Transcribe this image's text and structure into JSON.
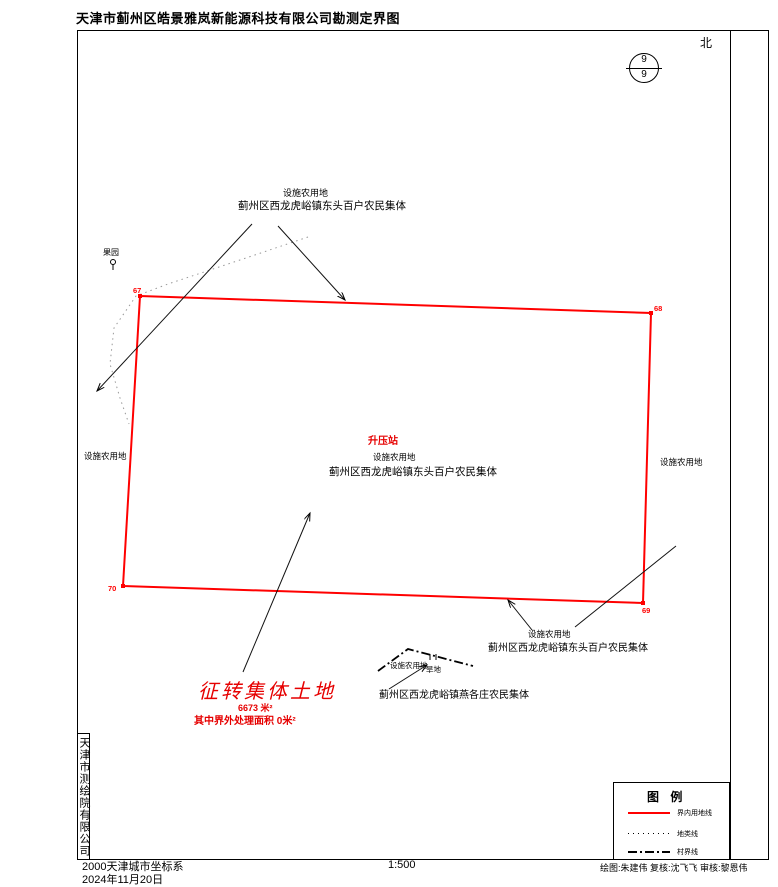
{
  "page": {
    "title": "天津市蓟州区皓景雅岚新能源科技有限公司勘测定界图"
  },
  "compass": {
    "north_label": "北",
    "sheet_number_top": "9",
    "sheet_number_bottom": "9"
  },
  "map": {
    "corners": [
      {
        "id": "67"
      },
      {
        "id": "68"
      },
      {
        "id": "69"
      },
      {
        "id": "70"
      }
    ],
    "labels": {
      "top_parcel_type": "设施农用地",
      "top_parcel_owner": "蓟州区西龙虎峪镇东头百户农民集体",
      "orchard": "果园",
      "station": "升压站",
      "center_parcel_type": "设施农用地",
      "center_parcel_owner": "蓟州区西龙虎峪镇东头百户农民集体",
      "left_parcel_type": "设施农用地",
      "right_parcel_type": "设施农用地",
      "bottom_right_parcel_type": "设施农用地",
      "bottom_right_parcel_owner": "蓟州区西龙虎峪镇东头百户农民集体",
      "bottom_mid_parcel_type": "设施农用地",
      "bottom_mid_dry_land": "旱地",
      "bottom_mid_parcel_owner": "蓟州区西龙虎峪镇燕各庄农民集体"
    },
    "acquisition_note": {
      "title": "征转集体土地",
      "area": "6673  米²",
      "outside_area": "其中界外处理面积  0米²"
    }
  },
  "legend": {
    "title": "图 例",
    "items": [
      {
        "label": "界内用地线",
        "style": "solid-red"
      },
      {
        "label": "地类线",
        "style": "dotted"
      },
      {
        "label": "村界线",
        "style": "dash-dot"
      }
    ]
  },
  "footer": {
    "coordinate_system": "2000天津城市坐标系",
    "date": "2024年11月20日",
    "scale": "1:500",
    "credits": "绘图:朱建伟  复核:沈飞飞  审核:黎恩伟",
    "agency": "天津市测绘院有限公司"
  },
  "colors": {
    "boundary_red": "#ff0000",
    "note_red": "#e60000"
  }
}
